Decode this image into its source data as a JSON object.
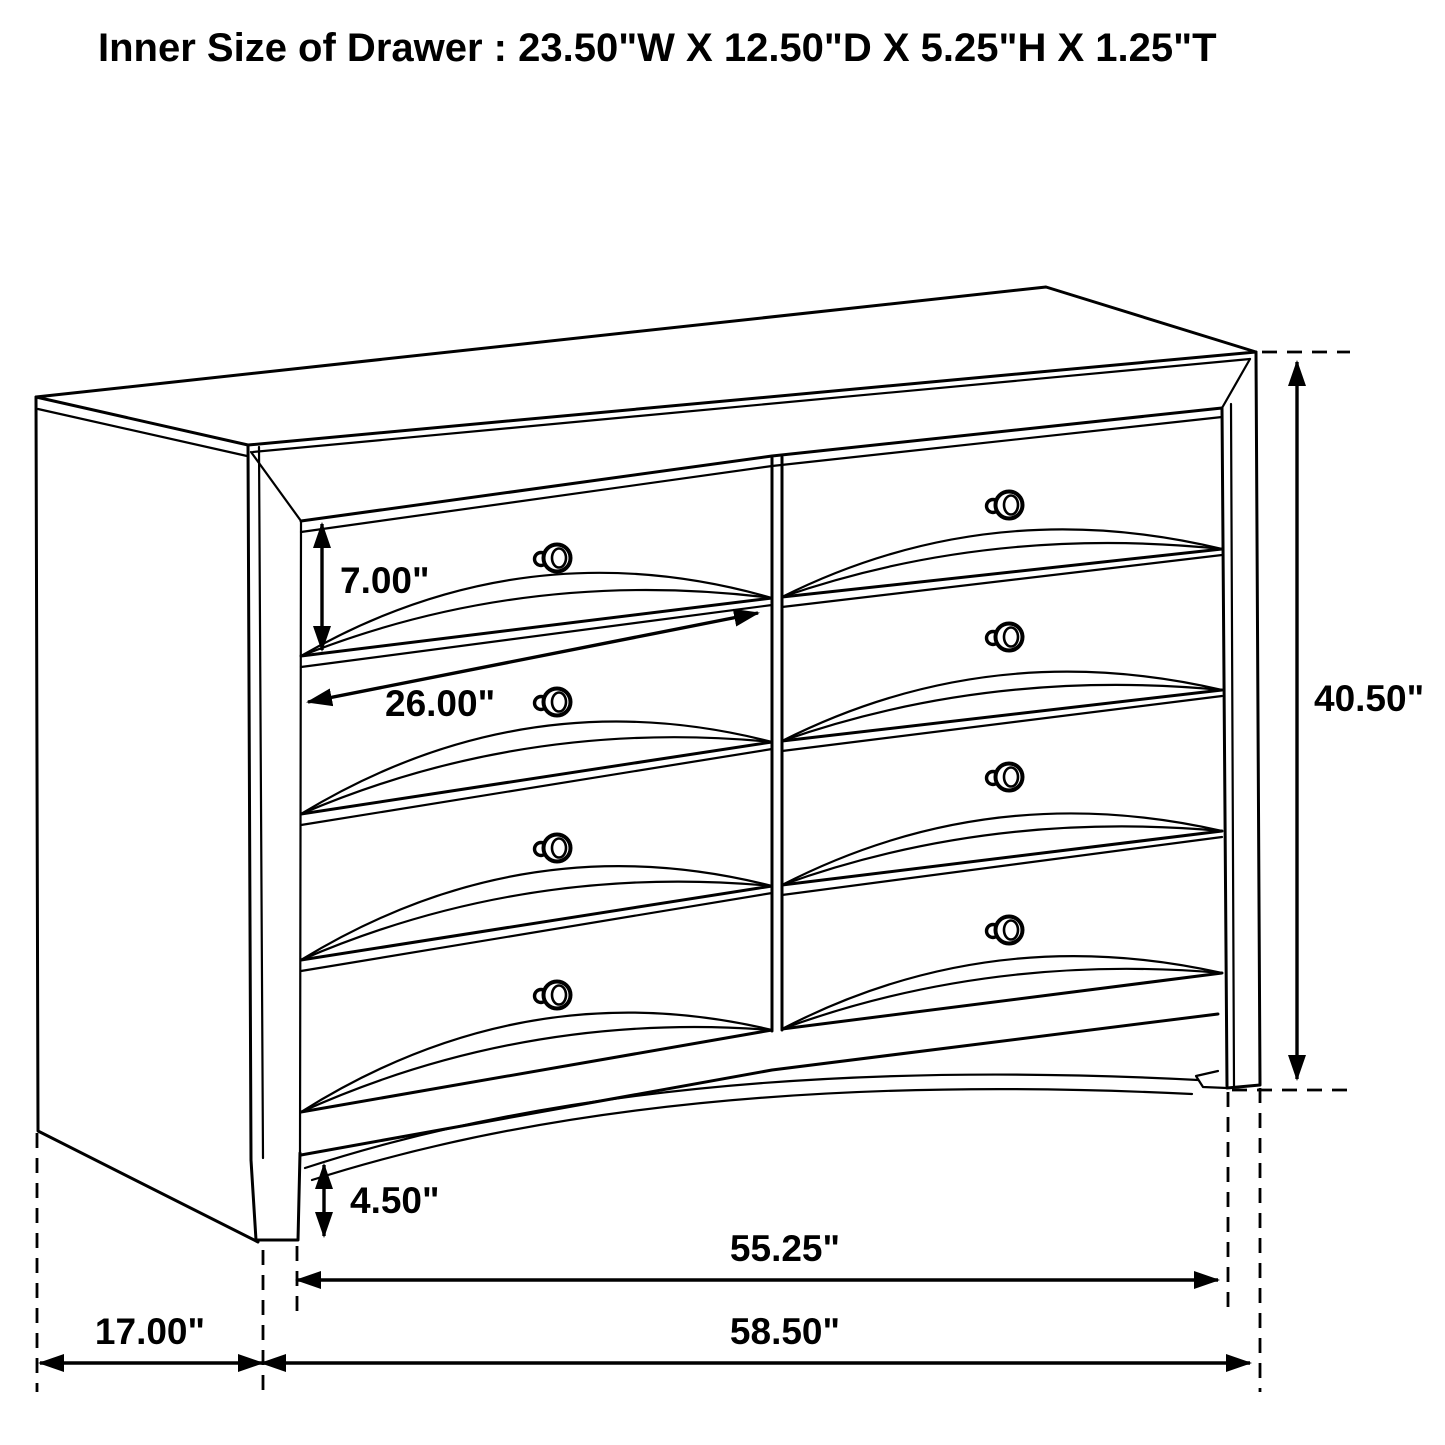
{
  "title": "Inner Size of Drawer : 23.50\"W X 12.50\"D X 5.25\"H X 1.25\"T",
  "diagram": {
    "type": "furniture-dimension-diagram",
    "subject": "dresser line drawing",
    "drawer_rows": 4,
    "drawer_columns": 2,
    "knob_count": 8,
    "inner_drawer_size": {
      "width": "23.50\"",
      "depth": "12.50\"",
      "height": "5.25\"",
      "thickness": "1.25\""
    },
    "dimensions": {
      "drawer_front_height": "7.00\"",
      "drawer_width": "26.00\"",
      "overall_height": "40.50\"",
      "base_foot_height": "4.50\"",
      "case_front_width": "55.25\"",
      "overall_width": "58.50\"",
      "side_depth": "17.00\""
    }
  },
  "labels": {
    "dim_drawer_height": "7.00\"",
    "dim_drawer_width": "26.00\"",
    "dim_overall_height": "40.50\"",
    "dim_foot_height": "4.50\"",
    "dim_case_width": "55.25\"",
    "dim_overall_width": "58.50\"",
    "dim_depth": "17.00\""
  },
  "styles": {
    "line_color": "#000000",
    "background": "#ffffff"
  }
}
